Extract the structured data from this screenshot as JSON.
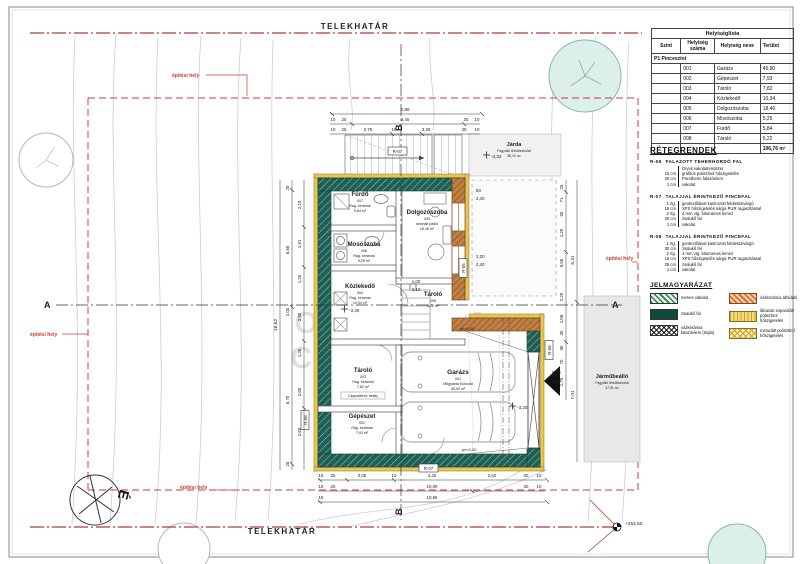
{
  "site": {
    "telekhatar_top": "TELEKHATÁR",
    "telekhatar_bottom": "TELEKHATÁR",
    "building_area_label": "építési hely",
    "corner_level": "+252,50",
    "north_letter": "É"
  },
  "room_list": {
    "title": "Helyiséglista",
    "headers": [
      "Szint",
      "Helyiség száma",
      "Helyiség neve",
      "Terület"
    ],
    "group": "P1 Pinceszint",
    "rows": [
      [
        "001",
        "Garázs",
        "45,90"
      ],
      [
        "002",
        "Gépészet",
        "7,93"
      ],
      [
        "003",
        "Tároló",
        "7,82"
      ],
      [
        "004",
        "Közlekedő",
        "10,34"
      ],
      [
        "005",
        "Dolgozószoba",
        "18,46"
      ],
      [
        "006",
        "Mosószoba",
        "5,25"
      ],
      [
        "007",
        "Fürdő",
        "5,84"
      ],
      [
        "008",
        "Tároló",
        "5,22"
      ]
    ],
    "total": "106,76 m²"
  },
  "layers": {
    "title": "RÉTEGRENDEK",
    "blocks": [
      {
        "code": "R-06",
        "name": "FALAZOTT TEHERHORDÓ FAL",
        "rows": [
          [
            "",
            "Dryvit vakolatrendszer"
          ],
          [
            "15 cm",
            "grafitos polisztirol hőszigetelés"
          ],
          [
            "30 cm",
            "Porotherm falazóelem"
          ],
          [
            "1 cm",
            "vakolat"
          ]
        ]
      },
      {
        "code": "R-07",
        "name": "TALAJJAL ÉRINTKEZŐ PINCEFAL",
        "rows": [
          [
            "1 rtg.",
            "geotextíliával kasírozott felületszivárgó"
          ],
          [
            "15 cm",
            "XPS hőszigetelés sárga PUR ragasztással"
          ],
          [
            "2 rtg.",
            "4 mm vtg. bitumenes lemez"
          ],
          [
            "30 cm",
            "zsalukő fal"
          ],
          [
            "1 cm",
            "vakolat"
          ]
        ]
      },
      {
        "code": "R-08",
        "name": "TALAJJAL ÉRINTKEZŐ PINCEFAL",
        "rows": [
          [
            "1 rtg.",
            "geotextíliával kasírozott felületszivárgó"
          ],
          [
            "30 cm",
            "zsalukő fal"
          ],
          [
            "2 rtg.",
            "4 mm vtg. bitumenes lemez"
          ],
          [
            "15 cm",
            "XPS hőszigetelés sárga PUR ragasztással"
          ],
          [
            "25 cm",
            "zsalukő fal"
          ],
          [
            "1 cm",
            "vakolat"
          ]
        ]
      }
    ]
  },
  "legend": {
    "title": "JELMAGYARÁZAT",
    "items": [
      {
        "swatch": "green-hatch",
        "label": "nemes vakolat"
      },
      {
        "swatch": "teal-solid",
        "label": "zsalukő fal"
      },
      {
        "swatch": "bw-cross",
        "label": "vázkerámia falazóelem (tégla)"
      },
      {
        "swatch": "orange-hatch",
        "label": "vázkerámia áthidaló"
      },
      {
        "swatch": "yellow-lines",
        "label": "lábazati expandált polisztirol hőszigetelés"
      },
      {
        "swatch": "yellow-cross",
        "label": "extrudált polisztirol hőszigetelés"
      }
    ]
  },
  "plan": {
    "rooms": {
      "furdo": {
        "name": "Fürdő",
        "num": "007",
        "finish": "Rag. kerámia",
        "area": "5,84 m²"
      },
      "dolgozo": {
        "name": "Dolgozószoba",
        "num": "005",
        "finish": "laminált padló",
        "area": "18,46 m²"
      },
      "moso": {
        "name": "Mosószoba",
        "num": "006",
        "finish": "Rag. kerámia",
        "area": "5,25 m²"
      },
      "kozlekedo": {
        "name": "Közlekedő",
        "num": "004",
        "finish": "Rag. kerámia",
        "area": "10,34 m²"
      },
      "tarolo8": {
        "name": "Tároló",
        "num": "008",
        "finish": "Rag. kerámia",
        "area": "5,22 m²"
      },
      "tarolo3": {
        "name": "Tároló",
        "num": "003",
        "finish": "Rag. kerámia",
        "area": "7,82 m²"
      },
      "gepeszet": {
        "name": "Gépészet",
        "num": "002",
        "finish": "Rag. kerámia",
        "area": "7,93 m²"
      },
      "garazs": {
        "name": "Garázs",
        "num": "001",
        "finish": "Műgyanta burkolat",
        "area": "45,90 m²"
      }
    },
    "outdoor": {
      "jarda": {
        "name": "Járda",
        "finish": "Fagyálló térkőburkolat",
        "area": "38,10 m²"
      },
      "jarmubeallo": {
        "name": "Járműbeálló",
        "finish": "Fagyálló térkőburkolat",
        "area": "47,91 m²"
      }
    },
    "extra": {
      "csapadek": "Csapadékvíz tartály"
    },
    "levels": {
      "l1": "-3,32",
      "l2": "-3,20",
      "l3": "-3,30",
      "pm1": "pm 0,00",
      "pm2": "pm 0,00"
    },
    "refs": {
      "r06": "R-06",
      "r07": "R-07",
      "r08": "R-08"
    },
    "sections": {
      "a": "A",
      "b": "B"
    },
    "watermark": {
      "line1": "OPTIMUM",
      "line2": "CENTRUM"
    }
  },
  "dims": {
    "top_total": "6,96",
    "top_row2": [
      "10",
      "25",
      "6,45",
      "30",
      "10"
    ],
    "top_row3": [
      "10",
      "25",
      "2,75",
      "10",
      "3,30",
      "30",
      "10"
    ],
    "bottom_row1": [
      "15",
      "25",
      "3,05",
      "10",
      "4,25",
      "2,60",
      "30",
      "10"
    ],
    "bottom_row2": [
      "15",
      "25",
      "10,00",
      "30",
      "10"
    ],
    "bottom_row3": [
      "15",
      "10,65"
    ],
    "left_outer": [
      "25",
      "6,50",
      "2,00",
      "6,70",
      "25"
    ],
    "left_inner": [
      "2,19",
      "1,91",
      "1,20",
      "2,90",
      "1,30",
      "2,60",
      "2,60"
    ],
    "left_total": "16,62",
    "right_upper": [
      "25",
      "71",
      "60",
      "1,20",
      "5,50",
      "2,20",
      "1,08",
      "30"
    ],
    "right_total": "6,31",
    "right_lower": [
      "90",
      "70",
      "1,70"
    ],
    "right_lower_total": "7,01",
    "garage_door": [
      "5,00",
      "2,40"
    ],
    "win1": [
      "60",
      "2,40"
    ],
    "win2": [
      "2,20",
      "2,40"
    ],
    "door_c": [
      "1,00",
      "2,10"
    ]
  }
}
